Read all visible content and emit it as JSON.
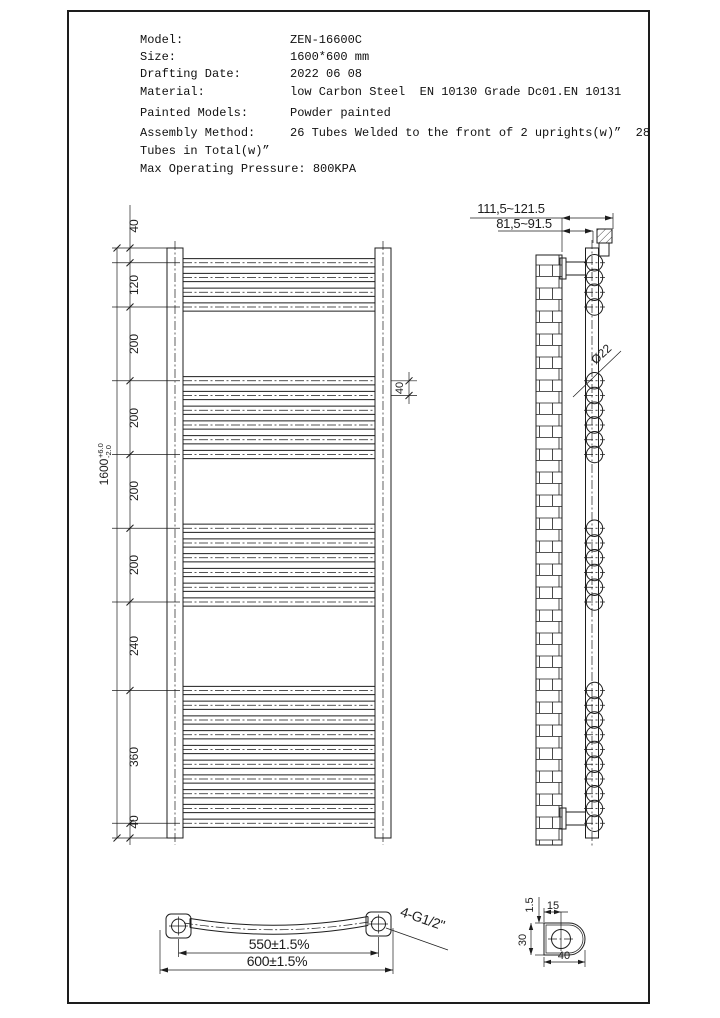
{
  "specs": {
    "rows": [
      {
        "label": "Model:",
        "value": "ZEN-16600C"
      },
      {
        "label": "Size:",
        "value": "1600*600 mm"
      },
      {
        "label": "Drafting Date:",
        "value": "2022 06 08"
      },
      {
        "label": "Material:",
        "value": "low Carbon Steel  EN 10130 Grade Dc01.EN 10131"
      },
      {
        "label": "Painted Models:",
        "value": "Powder painted"
      },
      {
        "label": "Assembly Method:",
        "value": "26 Tubes Welded to the front of 2 uprights(w)”  28"
      }
    ],
    "continuation": "Tubes in Total(w)”",
    "pressure_line": "Max Operating Pressure: 800KPA"
  },
  "front_view": {
    "left_dims": [
      "40",
      "120",
      "200",
      "200",
      "200",
      "200",
      "240",
      "360",
      "40"
    ],
    "overall_height": "1600",
    "tol_plus": "+6.0",
    "tol_minus": "-2.0",
    "tube_pitch": "40"
  },
  "side_view": {
    "wall_distance_outer": "111,5~121.5",
    "wall_distance_inner": "81,5~91.5",
    "tube_diameter": "Ø22"
  },
  "bottom_view": {
    "tube_centers_width": "550±1.5%",
    "overall_width": "600±1.5%",
    "thread_spec": "4-G1/2\""
  },
  "section_view": {
    "hole_offset": "15",
    "wall_thickness": "1.5",
    "depth": "30",
    "width": "40"
  },
  "colors": {
    "line": "#1d1d1d",
    "background": "#ffffff"
  }
}
